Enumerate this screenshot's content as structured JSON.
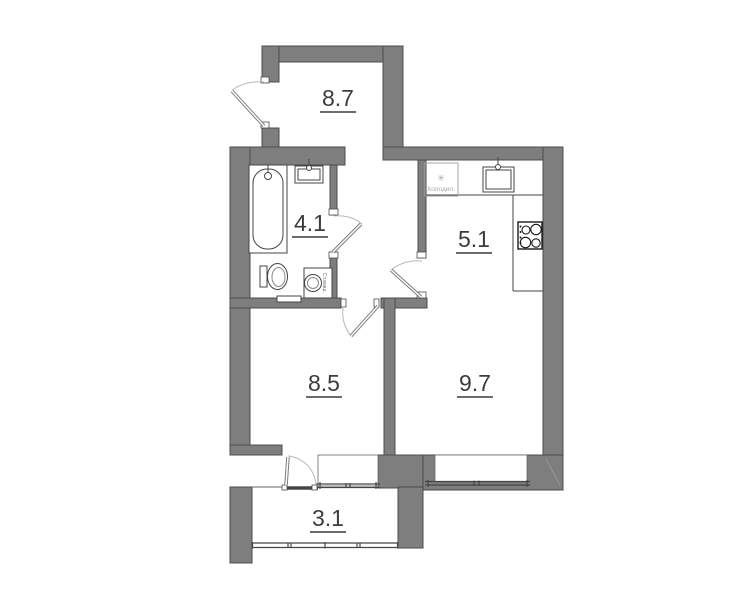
{
  "plan": {
    "rooms": [
      {
        "id": "hallway",
        "area": "8.7"
      },
      {
        "id": "bathroom",
        "area": "4.1"
      },
      {
        "id": "kitchen",
        "area": "5.1"
      },
      {
        "id": "room-1",
        "area": "8.5"
      },
      {
        "id": "room-2",
        "area": "9.7"
      },
      {
        "id": "balcony",
        "area": "3.1"
      }
    ],
    "appliances": {
      "fridge_icon": "✳",
      "fridge_label": "Холодил.",
      "washer_label": "Ст.маш."
    },
    "colors": {
      "wall_fill": "#7e7e7e",
      "wall_stroke": "#4c4c4c",
      "line": "#454545",
      "light_line": "#a6a6a6",
      "arc": "#b8b8b8",
      "label": "#3c3c3c",
      "background": "#ffffff"
    }
  }
}
